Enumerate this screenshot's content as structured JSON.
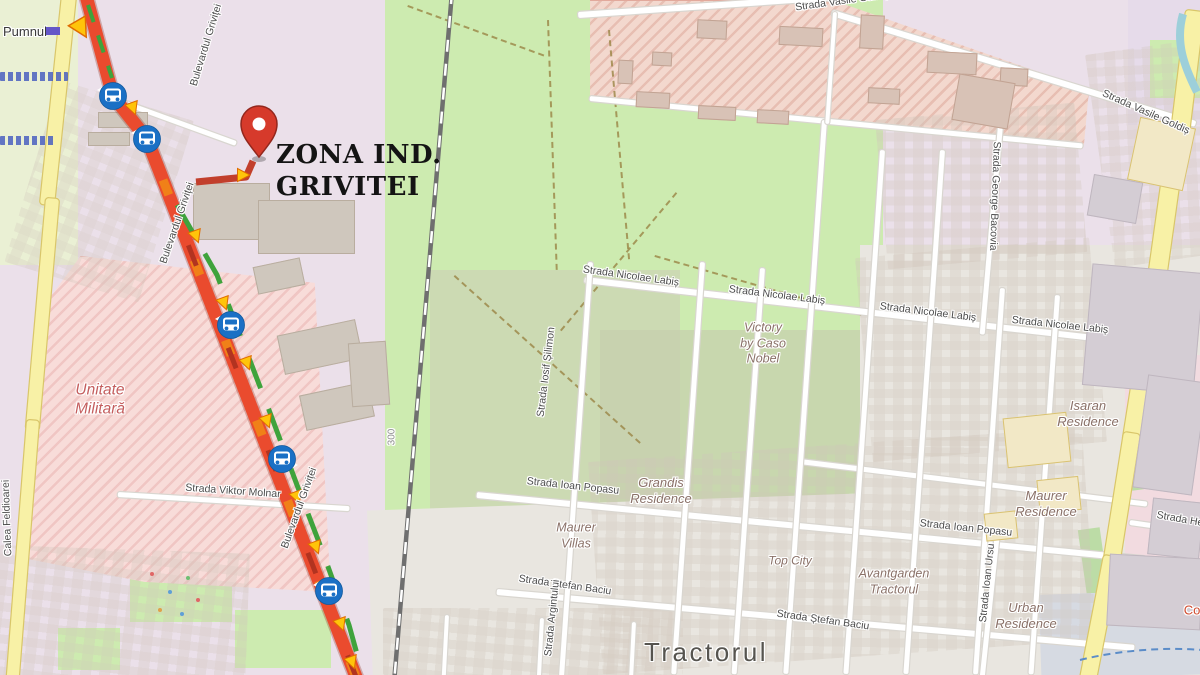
{
  "map": {
    "destination": {
      "line1": "ZONA IND.",
      "line2": "GRIVITEI"
    },
    "colors": {
      "route_red": "#ea4b2e",
      "traffic_green": "#3fa33c",
      "traffic_orange": "#f08018",
      "bus_blue": "#1a70c5",
      "pin_red": "#d63a2b",
      "park_green": "#cdebb0",
      "industrial_pink": "#f3d8ce",
      "military_pink": "#f8dcd9",
      "road_yellow": "#f8f1a6"
    },
    "street_labels": [
      {
        "id": "calea-feldioarei",
        "text": "Calea Feldioarei",
        "cx": 7,
        "cy": 518,
        "rot": -92
      },
      {
        "id": "bulevardul-grivitei-n",
        "text": "Bulevardul Griviței",
        "cx": 206,
        "cy": 45,
        "rot": -73
      },
      {
        "id": "bulevardul-grivitei-m",
        "text": "Bulevardul Griviței",
        "cx": 177,
        "cy": 223,
        "rot": -71
      },
      {
        "id": "bulevardul-grivitei-s",
        "text": "Bulevardul Griviței",
        "cx": 299,
        "cy": 508,
        "rot": -70
      },
      {
        "id": "vasile-goldis-n",
        "text": "Strada Vasile Goldiș",
        "cx": 842,
        "cy": 1,
        "rot": -8
      },
      {
        "id": "vasile-goldis-e",
        "text": "Strada Vasile Goldiș",
        "cx": 1146,
        "cy": 112,
        "rot": 24
      },
      {
        "id": "george-bacovia",
        "text": "Strada George Bacovia",
        "cx": 995,
        "cy": 196,
        "rot": 92
      },
      {
        "id": "nicolae-labis-a",
        "text": "Strada Nicolae Labiș",
        "cx": 631,
        "cy": 276,
        "rot": 8
      },
      {
        "id": "nicolae-labis-b",
        "text": "Strada Nicolae Labiș",
        "cx": 777,
        "cy": 295,
        "rot": 7
      },
      {
        "id": "nicolae-labis-c",
        "text": "Strada Nicolae Labiș",
        "cx": 928,
        "cy": 312,
        "rot": 7
      },
      {
        "id": "nicolae-labis-d",
        "text": "Strada Nicolae Labiș",
        "cx": 1060,
        "cy": 325,
        "rot": 6
      },
      {
        "id": "iosif-silimon",
        "text": "Strada Iosif Șilimon",
        "cx": 546,
        "cy": 372,
        "rot": -83
      },
      {
        "id": "ioan-popasu-a",
        "text": "Strada Ioan Popasu",
        "cx": 573,
        "cy": 486,
        "rot": 6
      },
      {
        "id": "ioan-popasu-b",
        "text": "Strada Ioan Popasu",
        "cx": 966,
        "cy": 528,
        "rot": 6
      },
      {
        "id": "ioan-ursu",
        "text": "Strada Ioan Ursu",
        "cx": 987,
        "cy": 583,
        "rot": -84
      },
      {
        "id": "stefan-baciu-a",
        "text": "Strada Ștefan Baciu",
        "cx": 565,
        "cy": 585,
        "rot": 8
      },
      {
        "id": "stefan-baciu-b",
        "text": "Strada Ștefan Baciu",
        "cx": 823,
        "cy": 620,
        "rot": 8
      },
      {
        "id": "viktor-molnar",
        "text": "Strada Viktor Molnar",
        "cx": 233,
        "cy": 491,
        "rot": 4
      },
      {
        "id": "argintului",
        "text": "Strada Argintului",
        "cx": 552,
        "cy": 618,
        "rot": -84
      },
      {
        "id": "strada-he",
        "text": "Strada He",
        "cx": 1180,
        "cy": 519,
        "rot": 10
      },
      {
        "id": "marker-300",
        "text": "300",
        "cx": 392,
        "cy": 437,
        "rot": -90,
        "color": "#8d8d8d",
        "size": 10
      },
      {
        "id": "co-partial",
        "text": "Co",
        "cx": 1192,
        "cy": 610,
        "rot": 0,
        "color": "#d04a2e",
        "size": 13
      }
    ],
    "place_labels": [
      {
        "id": "pumnul",
        "text": "Pumnul",
        "cx": 25,
        "cy": 32,
        "size": 13,
        "color": "#3a3a3a",
        "italic": false
      },
      {
        "id": "unitate-militara",
        "text": "Unitate\nMilitară",
        "cx": 100,
        "cy": 400,
        "size": 15.5,
        "color": "#c45d5d"
      },
      {
        "id": "victory-by-caso-nobel",
        "text": "Victory\nby Caso\nNobel",
        "cx": 763,
        "cy": 344,
        "size": 12.5
      },
      {
        "id": "isaran-residence",
        "text": "Isaran\nResidence",
        "cx": 1088,
        "cy": 414,
        "size": 13
      },
      {
        "id": "maurer-residence",
        "text": "Maurer\nResidence",
        "cx": 1046,
        "cy": 504,
        "size": 13
      },
      {
        "id": "grandis-residence",
        "text": "Grandis\nResidence",
        "cx": 661,
        "cy": 491,
        "size": 13
      },
      {
        "id": "maurer-villas",
        "text": "Maurer\nVillas",
        "cx": 576,
        "cy": 536,
        "size": 12.5
      },
      {
        "id": "top-city",
        "text": "Top City",
        "cx": 790,
        "cy": 561,
        "size": 12
      },
      {
        "id": "avantgarden-tractorul",
        "text": "Avantgarden\nTractorul",
        "cx": 894,
        "cy": 582,
        "size": 12.5
      },
      {
        "id": "urban-residence",
        "text": "Urban\nResidence",
        "cx": 1026,
        "cy": 616,
        "size": 13
      },
      {
        "id": "tractorul",
        "text": "Tractorul",
        "cx": 706,
        "cy": 652,
        "size": 26,
        "color": "#56544f",
        "italic": false,
        "ls": 2.5
      }
    ],
    "transit": {
      "bus_stops": [
        {
          "x": 113,
          "y": 96,
          "ptr": "tl"
        },
        {
          "x": 147,
          "y": 139,
          "ptr": "tl"
        },
        {
          "x": 231,
          "y": 325,
          "ptr": "tl"
        },
        {
          "x": 282,
          "y": 459,
          "ptr": "br"
        },
        {
          "x": 329,
          "y": 591,
          "ptr": "tl"
        }
      ],
      "destination_pin": {
        "x": 259,
        "y": 157
      }
    }
  }
}
